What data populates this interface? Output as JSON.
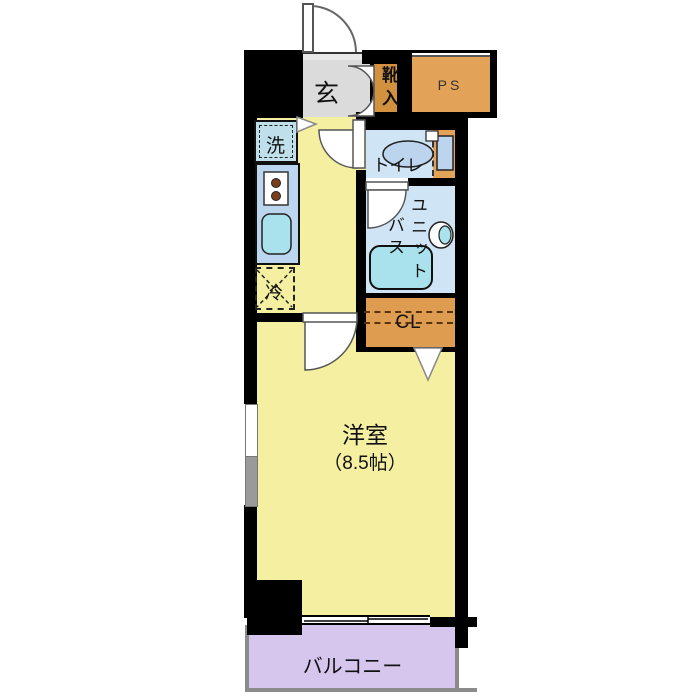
{
  "plan": {
    "type": "floor-plan",
    "labels": {
      "entrance": "玄",
      "shoe_cabinet": "靴入",
      "pipe_space": "PS",
      "washer": "洗",
      "toilet": "トイレ",
      "unit_bath_line1": "ユニット",
      "unit_bath_line2": "バス",
      "fridge": "冷",
      "closet": "CL",
      "main_room": "洋室",
      "main_room_size": "（8.5帖）",
      "balcony": "バルコニー"
    },
    "colors": {
      "wall": "#000000",
      "floor": "#F5EFA2",
      "entrance_floor": "#DBDBDB",
      "pipe_space": "#E2A257",
      "shoe_cabinet": "#D1913E",
      "closet": "#DE9C50",
      "kitchen_counter": "#BDD6EF",
      "wet_room_floor": "#CFE4F5",
      "fixtures": "#A9E2EC",
      "balcony": "#D6C6EE",
      "burner": "#7A3E1D"
    }
  }
}
